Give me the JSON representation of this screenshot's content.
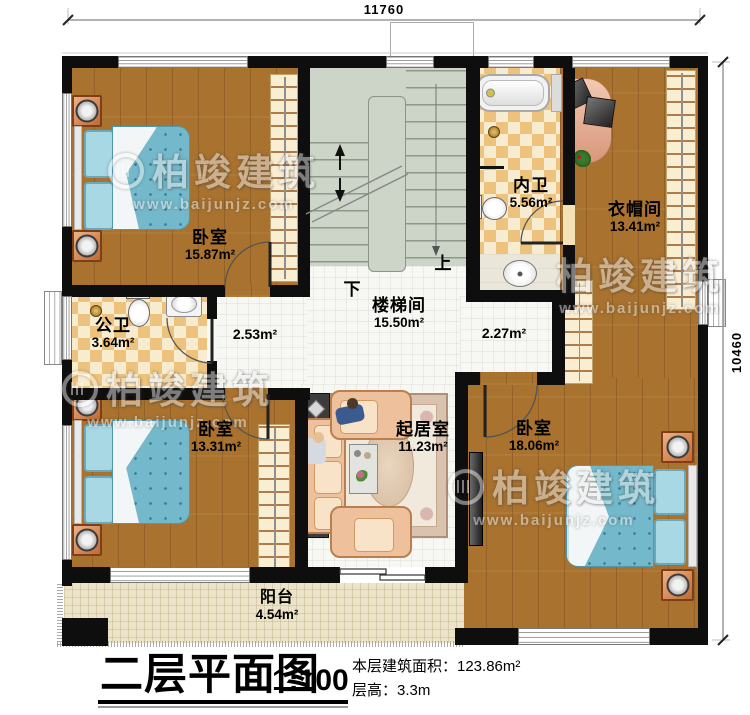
{
  "title_block": {
    "title": "二层平面图",
    "scale": "1:100",
    "area_line": "本层建筑面积：123.86m²",
    "height_line": "层高：3.3m"
  },
  "dimensions": {
    "top": "11760",
    "right": "10460"
  },
  "watermark": {
    "brand": "柏竣建筑",
    "url": "www.baijunjz.com"
  },
  "stairs": {
    "up": "上",
    "down": "下"
  },
  "rooms": {
    "bedroom_top_left": {
      "name": "卧室",
      "area": "15.87m²"
    },
    "public_bath": {
      "name": "公卫",
      "area": "3.64m²"
    },
    "stairwell": {
      "name": "楼梯间",
      "area": "15.50m²"
    },
    "inner_bath": {
      "name": "内卫",
      "area": "5.56m²"
    },
    "cloakroom": {
      "name": "衣帽间",
      "area": "13.41m²"
    },
    "hall_left": {
      "area": "2.53m²"
    },
    "hall_right": {
      "area": "2.27m²"
    },
    "bedroom_bottom_left": {
      "name": "卧室",
      "area": "13.31m²"
    },
    "living_room": {
      "name": "起居室",
      "area": "11.23m²"
    },
    "bedroom_bottom_right": {
      "name": "卧室",
      "area": "18.06m²"
    },
    "balcony": {
      "name": "阳台",
      "area": "4.54m²"
    }
  }
}
